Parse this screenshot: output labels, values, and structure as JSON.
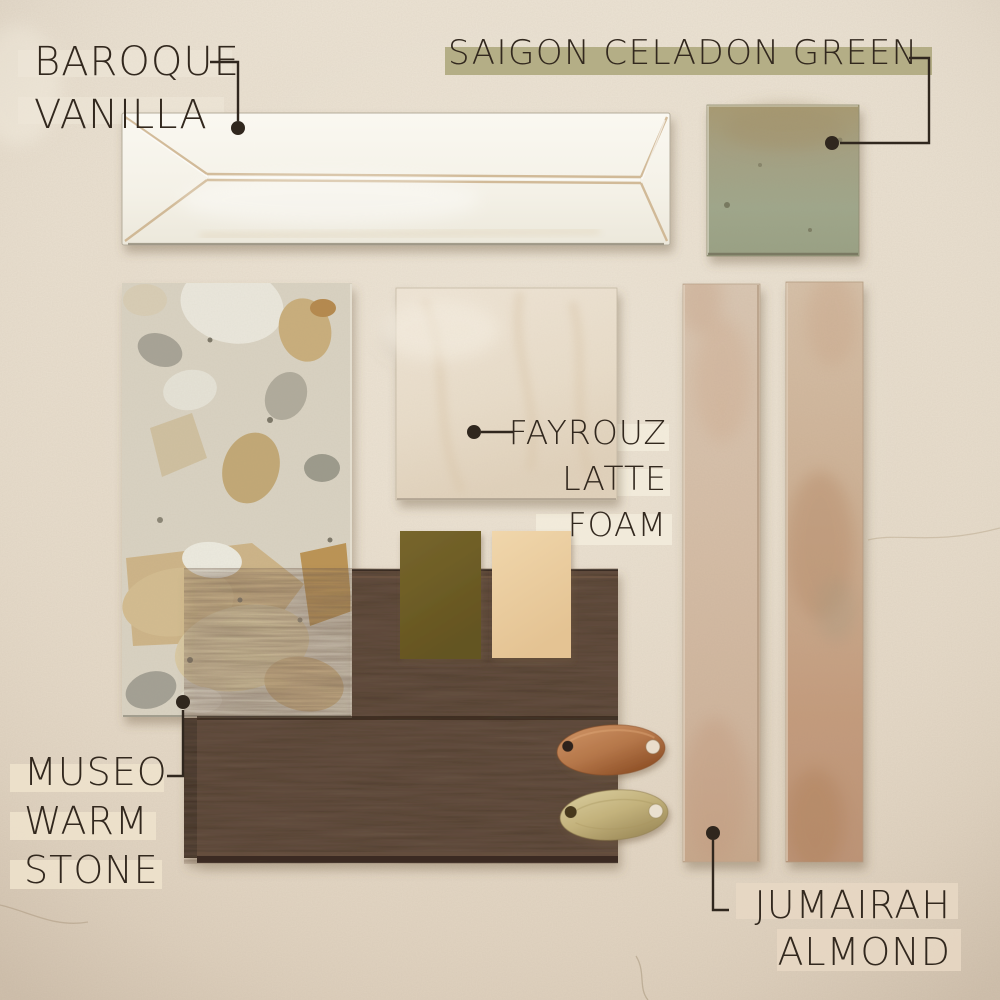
{
  "labels": {
    "baroque_vanilla": {
      "lines": [
        "BAROQUE",
        "VANILLA"
      ]
    },
    "saigon_celadon_green": {
      "lines": [
        "SAIGON CELADON GREEN"
      ]
    },
    "fayrouz_latte_foam": {
      "lines": [
        "FAYROUZ",
        "LATTE",
        "FOAM"
      ]
    },
    "museo_warm_stone": {
      "lines": [
        "MUSEO",
        "WARM",
        "STONE"
      ]
    },
    "jumairah_almond": {
      "lines": [
        "JUMAIRAH",
        "ALMOND"
      ]
    }
  },
  "colors": {
    "background": "#e7dccb",
    "ink": "#32281e",
    "sage_highlight": "#b1ab82",
    "cream_highlight": "#f2ebdb",
    "almond_highlight": "#e7d7c3",
    "white_tile": "#f5f2e9",
    "celadon_tile": "#a0a488",
    "celadon_tile_rust": "#a89a71",
    "fayrouz_tile": "#e9ddcb",
    "museo_terrazzo_base": "#d9d2c2",
    "olive_chip": "#6e5d26",
    "cream_chip": "#eccfa2",
    "wood_plank": "#4d392b",
    "copper_tag": "#b5774a",
    "brass_tag": "#c6b989",
    "almond_tile": "#d4bda5"
  }
}
